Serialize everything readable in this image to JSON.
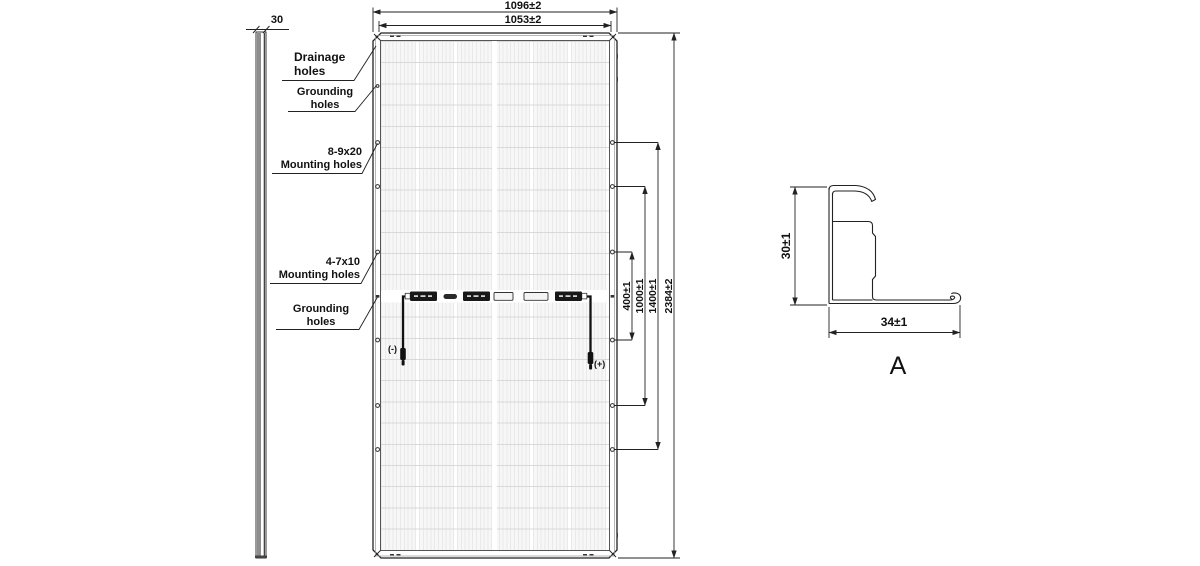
{
  "drawing": {
    "title_hint": "Solar module outline drawing",
    "side_view": {
      "thickness": "30"
    },
    "panel": {
      "dim_width_outer": "1096±2",
      "dim_width_inner": "1053±2",
      "callouts": [
        {
          "line1": "Drainage",
          "line2": "holes"
        },
        {
          "line1": "Grounding",
          "line2": "holes"
        },
        {
          "line1": "8-9x20",
          "line2": "Mounting holes"
        },
        {
          "line1": "4-7x10",
          "line2": "Mounting holes"
        },
        {
          "line1": "Grounding",
          "line2": "holes"
        }
      ],
      "right_dims": {
        "d400": "400±1",
        "d1000": "1000±1",
        "d1400": "1400±1",
        "d2384": "2384±2"
      },
      "junction": {
        "negative": "(-)",
        "positive": "(+)"
      }
    },
    "section_a": {
      "height_dim": "30±1",
      "width_dim": "34±1",
      "label": "A"
    },
    "colors": {
      "line": "#222222",
      "grid_line": "#d9d9d9",
      "cell_tint": "#f4f4f4",
      "box_dark": "#181818"
    }
  }
}
